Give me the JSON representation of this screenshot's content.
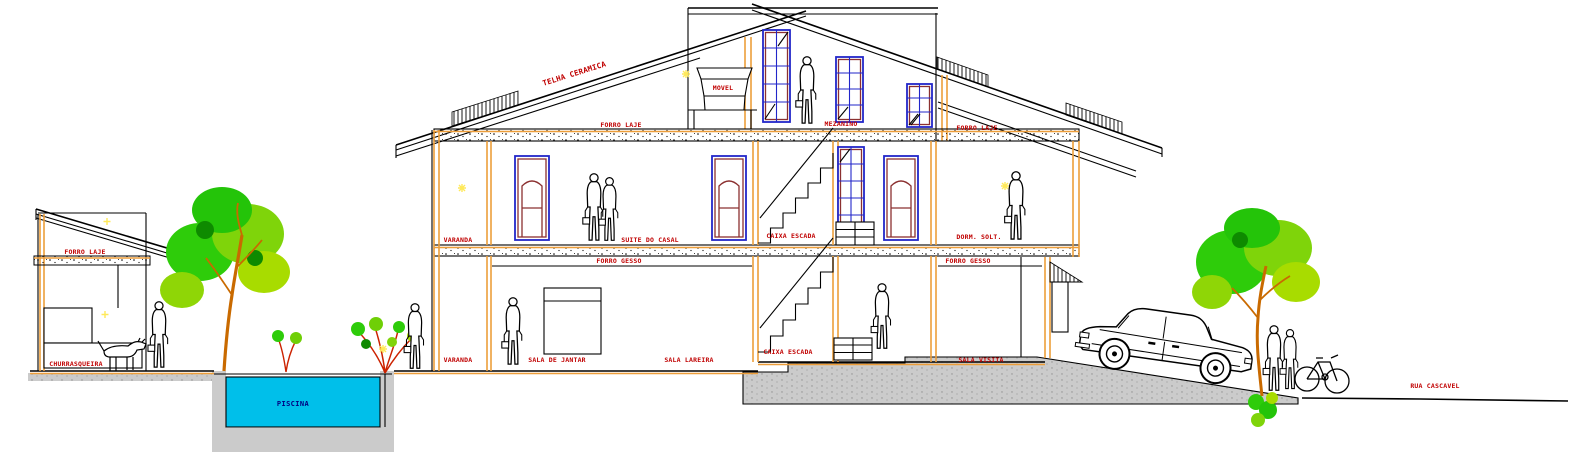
{
  "drawing": {
    "type": "architectural-cross-section",
    "labels": {
      "roof_tile": "TELHA CERAMICA",
      "attic_furniture": "MOVEL",
      "attic_slab_left": "FORRO LAJE",
      "mezzanine": "MEZANINO",
      "attic_slab_right": "FORRO LAJE",
      "balcony_middle": "VARANDA",
      "master_suite": "SUITE DO CASAL",
      "stairwell_middle": "CAIXA ESCADA",
      "single_bedroom": "DORM. SOLT.",
      "plaster_ceiling_left": "FORRO GESSO",
      "plaster_ceiling_right": "FORRO GESSO",
      "balcony_ground": "VARANDA",
      "dining_room": "SALA DE JANTAR",
      "fireplace_room": "SALA LAREIRA",
      "stairwell_ground": "CAIXA ESCADA",
      "sitting_room": "SALA VISITA",
      "annex_slab": "FORRO LAJE",
      "bbq_area": "CHURRASQUEIRA",
      "pool": "PISCINA",
      "street": "RUA CASCAVEL"
    },
    "colors": {
      "annotation_red": "#C00000",
      "wall_orange": "#ED9E3A",
      "frame_blue": "#2226C9",
      "door_maroon": "#8B3030",
      "pool_cyan": "#00BFEA",
      "pool_text_navy": "#000080",
      "terrain_gray": "#CBCBCB",
      "foliage_green": "#2ECC0A",
      "foliage_yellow_green": "#A8DC00",
      "trunk_brown": "#C96A00",
      "accent_yellow": "#FFE95A"
    },
    "entities": [
      "two-story house section with attic",
      "barbecue annex",
      "swimming pool",
      "two trees",
      "shrubs",
      "eight people",
      "embracing couple",
      "dog",
      "sedan car",
      "bicycle"
    ]
  }
}
